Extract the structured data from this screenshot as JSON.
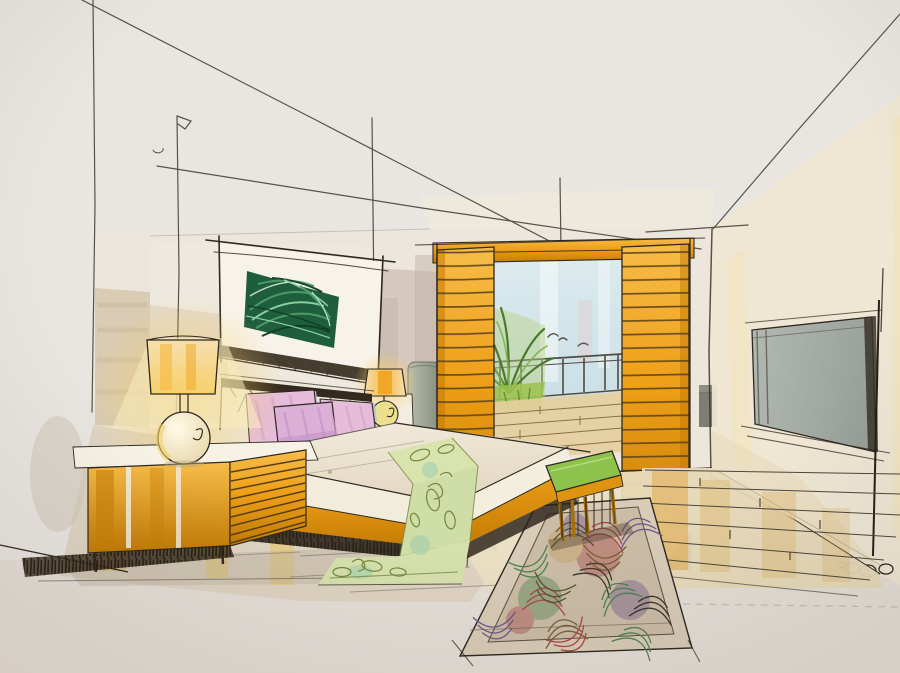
{
  "meta": {
    "title": "Hand-drawn marker sketch of a modern bedroom interior",
    "medium": "ink pen and marker / watercolor on paper",
    "description": "Two-point perspective interior rendering of a bedroom: bed with pink pillows and green runner, orange slatted sliding shutters opening to a balcony with a palm and railing, framed tropical leaf artwork, sphere table lamps, orange dresser, swirl-patterned rug and wood plank floor."
  },
  "objects": {
    "construction": {
      "label": "perspective construction lines"
    },
    "backWall": {
      "label": "back wall"
    },
    "artwork": {
      "label": "framed tropical leaf artwork"
    },
    "doorway": {
      "label": "balcony doorway with orange slatted sliding shutters"
    },
    "shutterLeft": {
      "label": "left slatted shutter panel"
    },
    "shutterRight": {
      "label": "right slatted shutter panel"
    },
    "balcony": {
      "label": "balcony view with sky, palm plant, railing and deck"
    },
    "palm": {
      "label": "palm plant"
    },
    "railing": {
      "label": "balcony railing"
    },
    "rightWall": {
      "label": "right wall with recessed gray panel"
    },
    "panel": {
      "label": "gray wall panel"
    },
    "floor": {
      "label": "wood plank floor"
    },
    "dresser": {
      "label": "orange dresser / left nightstand"
    },
    "lampLeft": {
      "label": "sphere table lamp with drum shade"
    },
    "lampRight": {
      "label": "small glowing table lamp"
    },
    "nightstandRight": {
      "label": "right nightstand with gray column vase"
    },
    "headboard": {
      "label": "dark-edged headboard"
    },
    "pillows": {
      "label": "pink and lavender pillows"
    },
    "bed": {
      "label": "bed with cream bedding and orange base band"
    },
    "runner": {
      "label": "green leaf-patterned bed runner"
    },
    "bench": {
      "label": "green bedside bench"
    },
    "rug": {
      "label": "multicolor swirl-patterned area rug"
    },
    "signature": {
      "label": "circle doodles at wall base"
    }
  },
  "palette": {
    "paper": "#e9e5e0",
    "paperEdge": "#ddd5cc",
    "ink": "#2e2820",
    "pencil": "#8d8477",
    "orange": "#ee9f17",
    "orangeDeep": "#c27a04",
    "orangeLight": "#f7bc49",
    "orangePale": "#f6dfae",
    "glow": "#f7d06a",
    "tan": "#d6c6ab",
    "mauve": "#c0afa4",
    "cream": "#f3ecdd",
    "creamDark": "#e3d8c2",
    "artDark": "#1f5e3c",
    "artMid": "#4d9e6b",
    "artLight": "#8fd3a8",
    "palm": "#4a7a2c",
    "palmLight": "#7fb449",
    "pillow": "#e5bcd9",
    "pillowDeep": "#bf93c8",
    "pillowBlue": "#b4c3d6",
    "runner": "#d5e0ac",
    "runnerInk": "#77853f",
    "bench": "#8dc24c",
    "sky": "#dcebee",
    "skyDeep": "#c8dde4",
    "panel": "#b2b8b2",
    "panelDeep": "#99a09a",
    "column": "#a3a896",
    "floor": "#e7d9b8",
    "floorWash": "#ddd2bf",
    "woodInk": "#4d463a",
    "shadow": "#2c2318",
    "rugBase": "#cbbca6",
    "rugBorder": "#d8ccb8",
    "teal": "#98ccae",
    "rugRed": "#a84848",
    "rugPurple": "#70588c",
    "rugGreen": "#4f8350",
    "rugOlive": "#5a5530",
    "rugBrown": "#7a5f38"
  }
}
